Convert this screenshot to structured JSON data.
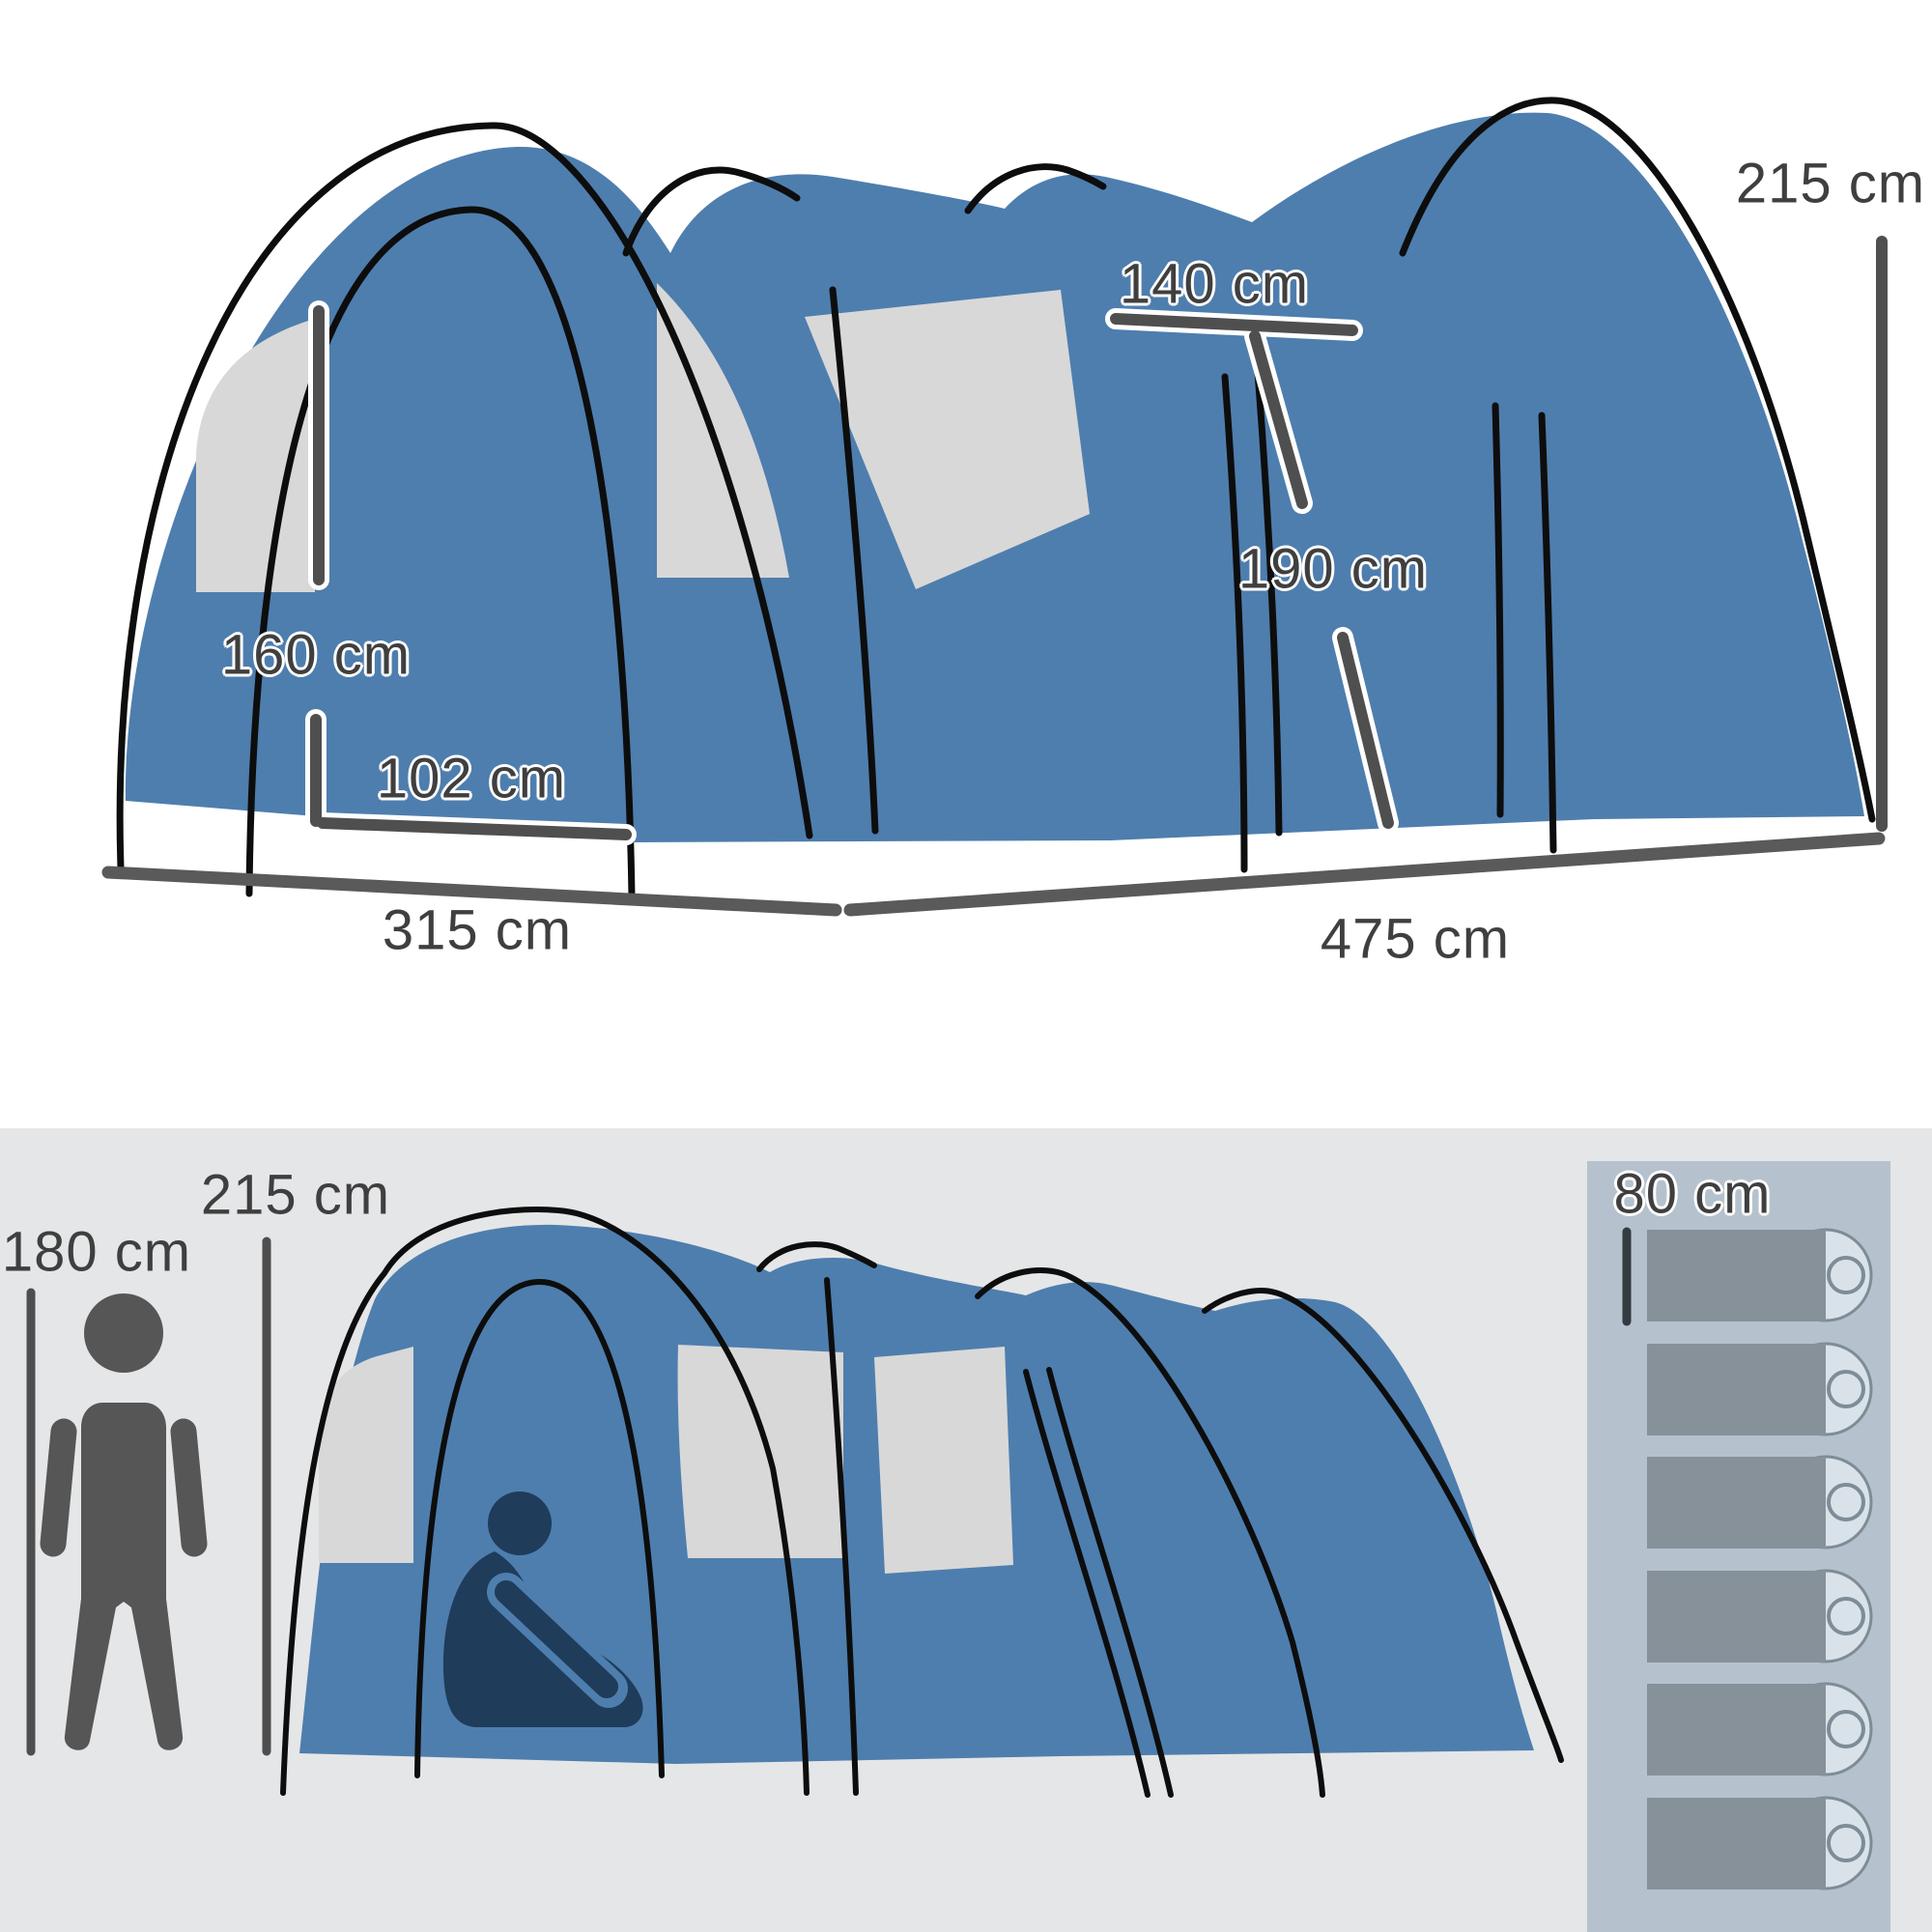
{
  "scene": {
    "description": "Product dimension infographic of a blue tunnel camping tent, perspective view on top and side view with human scale figure and sleeping-bag layout below"
  },
  "colors": {
    "tent_blue": "#4E7EAE",
    "window_gray": "#D8D8D8",
    "pole_black": "#0D0D0D",
    "dim_line": "#4F4F4F",
    "text": "#3F3F3F",
    "bottom_background": "#E5E6E7",
    "bag_panel": "#B5C2CD",
    "bag_body": "#87919A",
    "bag_head": "#D9E2E9",
    "person_gray": "#565656",
    "person_navy": "#1F3C5B"
  },
  "top_view": {
    "labels": {
      "rear_height": "215 cm",
      "inner_width": "140 cm",
      "inner_height": "190 cm",
      "door_height": "160 cm",
      "door_width": "102 cm",
      "front_width": "315 cm",
      "side_length": "475 cm"
    }
  },
  "bottom_view": {
    "labels": {
      "tent_height": "215 cm",
      "person_height": "180 cm",
      "bag_width": "80 cm"
    },
    "sleeping_bags_count": 6
  }
}
